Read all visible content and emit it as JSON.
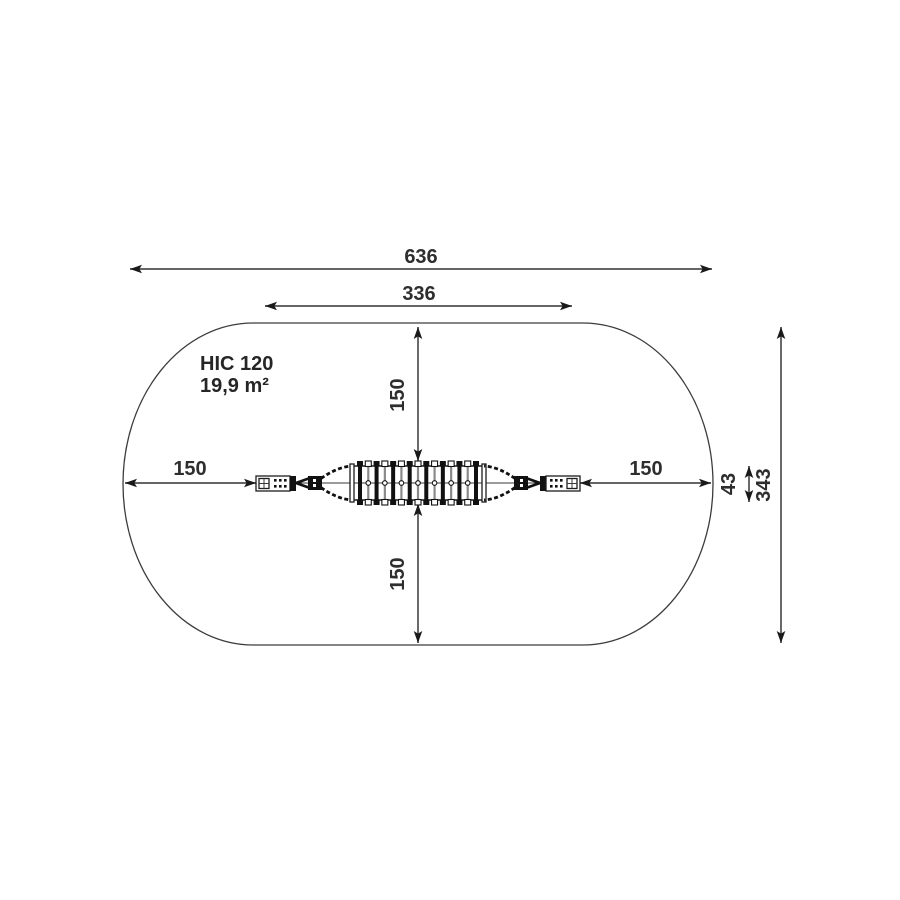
{
  "diagram": {
    "info": {
      "hic_label": "HIC 120",
      "area_label": "19,9 m²"
    },
    "dimensions": {
      "overall_width": "636",
      "equipment_width": "336",
      "left_clearance": "150",
      "right_clearance": "150",
      "top_clearance": "150",
      "bottom_clearance": "150",
      "equipment_depth": "43",
      "overall_depth": "343"
    },
    "colors": {
      "background": "#ffffff",
      "outline": "#3c3c3c",
      "dimension_line": "#4f4f4f",
      "text": "#2e2e2e",
      "equipment": "#111111"
    }
  }
}
